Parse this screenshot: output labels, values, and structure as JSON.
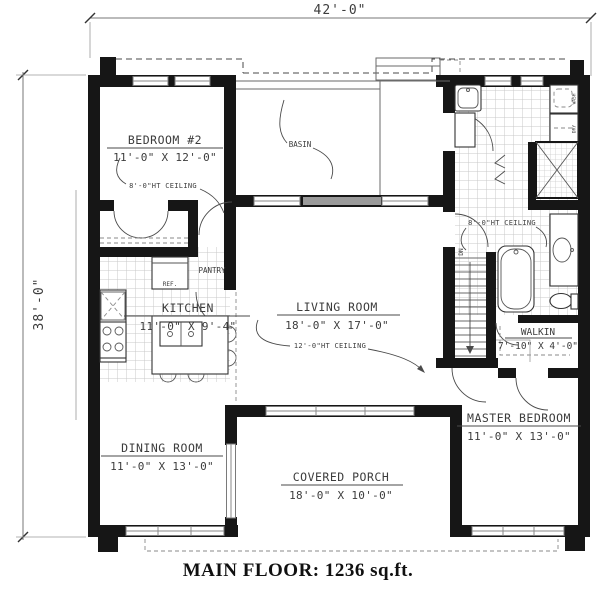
{
  "footer": "MAIN FLOOR: 1236 sq.ft.",
  "dimensions": {
    "overall_width": "42'-0\"",
    "overall_height": "38'-0\""
  },
  "rooms": {
    "bedroom2": {
      "name": "BEDROOM #2",
      "size": "11'-0\" X 12'-0\"",
      "note": "8'-0\"HT CEILING"
    },
    "basin": {
      "name": "BASIN"
    },
    "pantry": {
      "name": "PANTRY"
    },
    "kitchen": {
      "name": "KITCHEN",
      "size": "11'-0\" X 9'-4\""
    },
    "living_room": {
      "name": "LIVING ROOM",
      "size": "18'-0\" X 17'-0\"",
      "note": "12'-0\"HT CEILING"
    },
    "dining_room": {
      "name": "DINING ROOM",
      "size": "11'-0\" X 13'-0\""
    },
    "covered_porch": {
      "name": "COVERED PORCH",
      "size": "18'-0\" X 10'-0\""
    },
    "master_bedroom": {
      "name": "MASTER BEDROOM",
      "size": "11'-0\" X 13'-0\""
    },
    "walkin": {
      "name": "WALKIN",
      "size": "7'-10\" X 4'-0\""
    },
    "bathroom": {
      "note": "8'-0\"HT CEILING"
    }
  },
  "fixtures": {
    "refrigerator": "REF.",
    "stairs_down": "DN",
    "washer": "WASH",
    "dryer": "DRY"
  },
  "colors": {
    "wall": "#161616",
    "line": "#6a6a6a",
    "tile_grout": "#c9c9c9",
    "text": "#3c3c3c"
  }
}
